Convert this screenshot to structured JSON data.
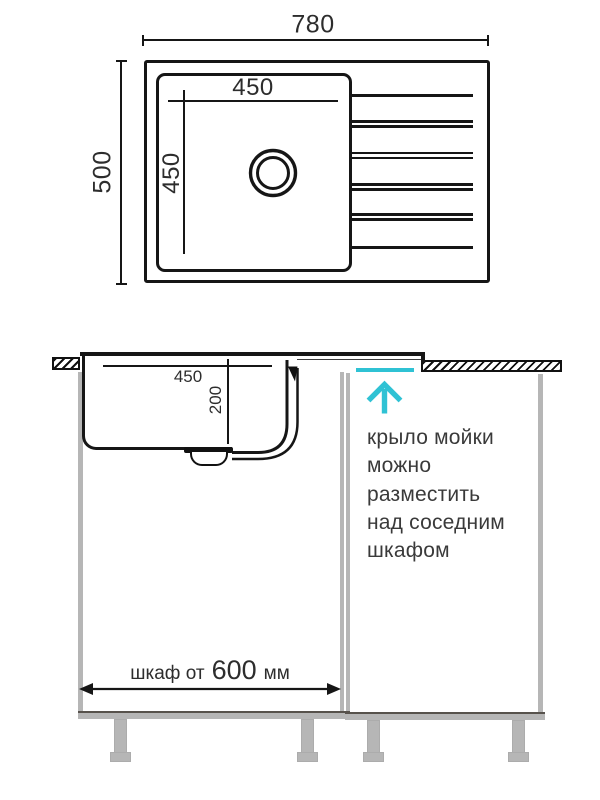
{
  "top_view": {
    "overall_width": "780",
    "overall_depth": "500",
    "bowl_width": "450",
    "bowl_depth": "450"
  },
  "section_view": {
    "bowl_width": "450",
    "bowl_depth": "200",
    "cabinet_dim_prefix": "шкаф от",
    "cabinet_dim_value": "600",
    "cabinet_dim_unit": "мм",
    "note_lines": [
      "крыло мойки",
      "можно",
      "разместить",
      "над соседним",
      "шкафом"
    ]
  },
  "colors": {
    "accent_cyan": "#2fc2d4",
    "line_black": "#161616",
    "cabinet_gray": "#b6b6b6",
    "note_text": "#3a3a3a"
  }
}
